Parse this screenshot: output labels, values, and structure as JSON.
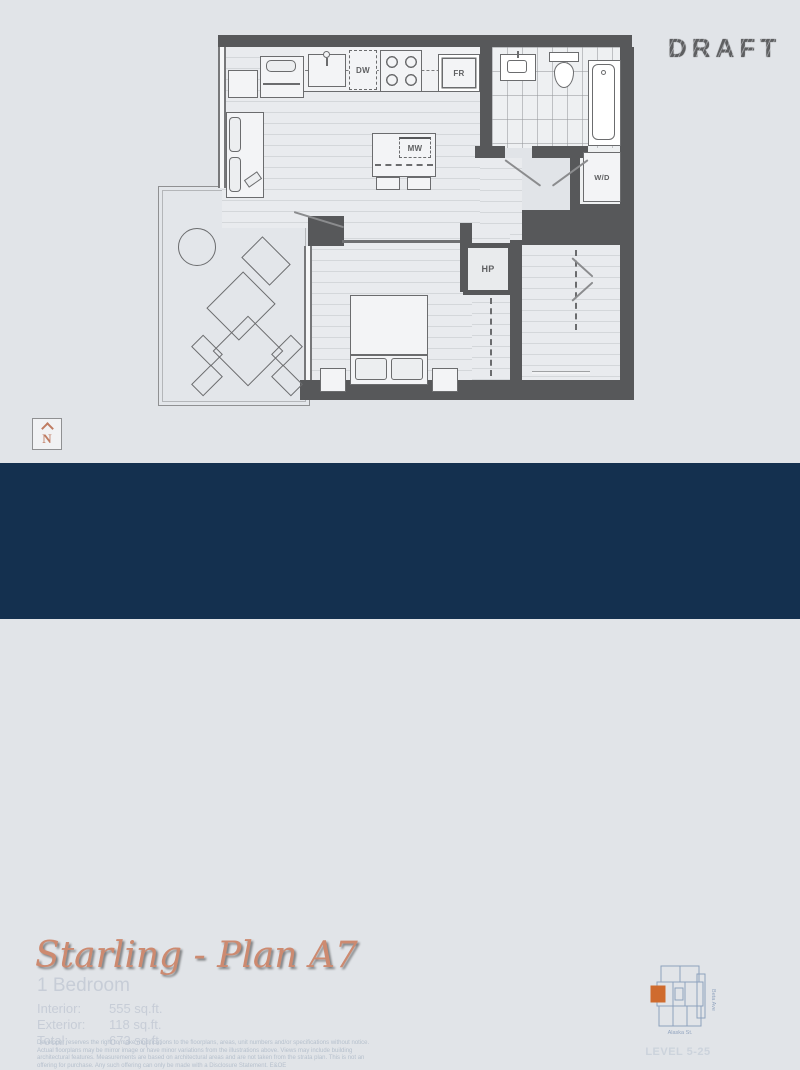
{
  "draft_label": "DRAFT",
  "floorplan": {
    "appliances": {
      "dw": "DW",
      "fr": "FR",
      "mw": "MW",
      "wd": "W/D",
      "hp": "HP"
    },
    "north_label": "N"
  },
  "info": {
    "title": "Starling - Plan A7",
    "subtitle": "1 Bedroom",
    "areas": [
      {
        "label": "Interior:",
        "value": "555 sq.ft."
      },
      {
        "label": "Exterior:",
        "value": "118 sq.ft."
      },
      {
        "label": "Total:",
        "value": "673 sq.ft."
      }
    ],
    "disclaimer": "Developer reserves the right to make modifications to the floorplans, areas, unit numbers and/or specifications without notice. Actual floorplans may be mirror image or have minor variations from the illustrations above. Views may include building architectural features. Measurements are based on architectural areas and are not taken from the strata plan. This is not an offering for purchase. Any such offering can only be made with a Disclosure Statement. E&OE"
  },
  "keyplan": {
    "street_bottom": "Alaska St.",
    "street_right": "Beta Ave",
    "level_label": "LEVEL 5-25",
    "highlight_color": "#cf6b2e"
  },
  "colors": {
    "background": "#e1e4e8",
    "walls": "#57585a",
    "band_navy": "#14304f",
    "title_salmon": "#cd8a70",
    "keyplan_stroke": "#8da2bd"
  }
}
